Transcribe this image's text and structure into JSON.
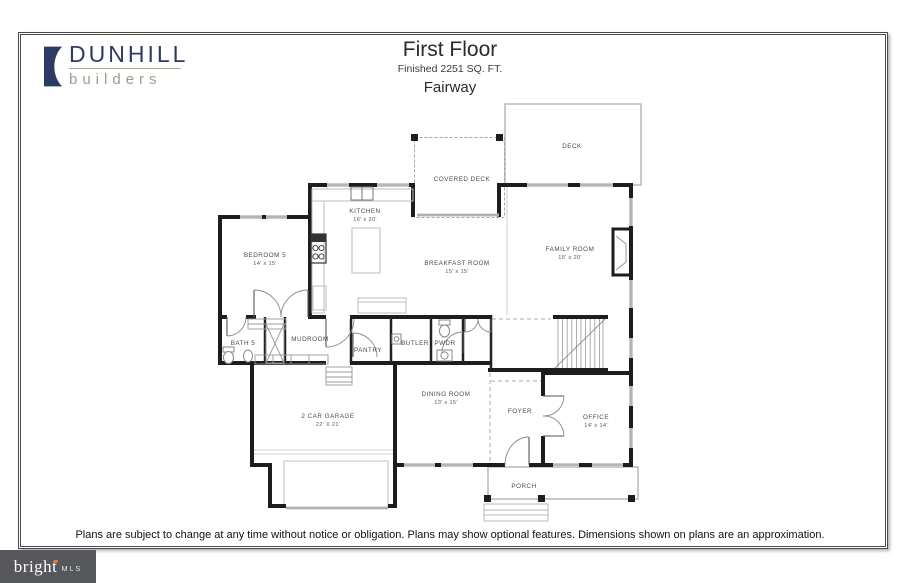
{
  "header": {
    "logo": {
      "brand": "DUNHILL",
      "tagline": "builders"
    },
    "title": "First Floor",
    "subtitle": "Finished 2251 SQ. FT.",
    "plan_name": "Fairway"
  },
  "plan": {
    "rooms": [
      {
        "name": "DECK",
        "dims": ""
      },
      {
        "name": "COVERED DECK",
        "dims": ""
      },
      {
        "name": "KITCHEN",
        "dims": "16' x 20'"
      },
      {
        "name": "BEDROOM 5",
        "dims": "14' x 15'"
      },
      {
        "name": "BREAKFAST ROOM",
        "dims": "15' x 15'"
      },
      {
        "name": "FAMILY ROOM",
        "dims": "15' x 20'"
      },
      {
        "name": "BATH 5",
        "dims": ""
      },
      {
        "name": "MUDROOM",
        "dims": ""
      },
      {
        "name": "PANTRY",
        "dims": ""
      },
      {
        "name": "BUTLER",
        "dims": ""
      },
      {
        "name": "PWDR",
        "dims": ""
      },
      {
        "name": "2 CAR GARAGE",
        "dims": "22' X 21'"
      },
      {
        "name": "DINING ROOM",
        "dims": "13' x 15'"
      },
      {
        "name": "FOYER",
        "dims": ""
      },
      {
        "name": "OFFICE",
        "dims": "14' x 14'"
      },
      {
        "name": "PORCH",
        "dims": ""
      }
    ]
  },
  "footer": {
    "disclaimer": "Plans are subject to change at any time without notice or obligation. Plans may show optional features. Dimensions shown on plans are an approximation.",
    "mls": {
      "brand": "bright",
      "suffix": "MLS"
    }
  },
  "colors": {
    "wall": "#1d1d1d",
    "window": "#cdcdcd",
    "logo_navy": "#2c3a64",
    "logo_rule_tan": "#b3aa85",
    "logo_gray": "#9b9b9b",
    "mls_bg": "#55575a",
    "mls_accent": "#e07b39"
  }
}
